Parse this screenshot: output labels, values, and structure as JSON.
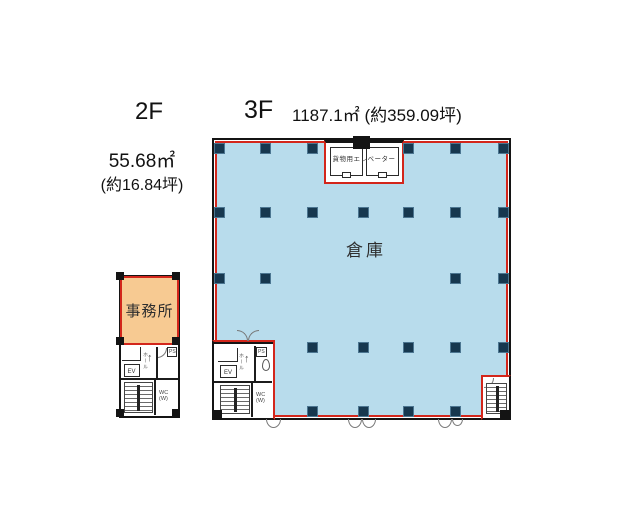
{
  "header": {
    "floor2_label": "2F",
    "floor2_area": "55.68㎡",
    "floor2_tsubo": "(約16.84坪)",
    "floor3_label": "3F",
    "floor3_area": "1187.1㎡ (約359.09坪)"
  },
  "floor2": {
    "room_label": "事務所",
    "elevator_label": "EV",
    "ps_label": "PS",
    "hall_label": "ホール",
    "hall_arrow": "↑",
    "wc_label": "WC",
    "wc_sub": "(W)"
  },
  "floor3": {
    "room_label": "倉庫",
    "freight_elevator_label": "貨物用エレベーター",
    "elevator_label": "EV",
    "ps_label": "PS",
    "hall_label": "ホール",
    "hall_arrow": "↑",
    "wc_label": "WC",
    "wc_sub": "(W)",
    "columns": [
      [
        219,
        148
      ],
      [
        265,
        148
      ],
      [
        312,
        148
      ],
      [
        408,
        148
      ],
      [
        455,
        148
      ],
      [
        503,
        148
      ],
      [
        219,
        212
      ],
      [
        265,
        212
      ],
      [
        312,
        212
      ],
      [
        363,
        212
      ],
      [
        408,
        212
      ],
      [
        455,
        212
      ],
      [
        503,
        212
      ],
      [
        219,
        278
      ],
      [
        265,
        278
      ],
      [
        455,
        278
      ],
      [
        503,
        278
      ],
      [
        312,
        347
      ],
      [
        363,
        347
      ],
      [
        408,
        347
      ],
      [
        455,
        347
      ],
      [
        503,
        347
      ],
      [
        312,
        411
      ],
      [
        363,
        411
      ],
      [
        408,
        411
      ],
      [
        455,
        411
      ]
    ]
  },
  "colors": {
    "floor_fill": "#b8dcec",
    "column": "#17384f",
    "lease_outline": "#d3261b",
    "office_fill": "#f7ca92",
    "wall": "#141414"
  }
}
